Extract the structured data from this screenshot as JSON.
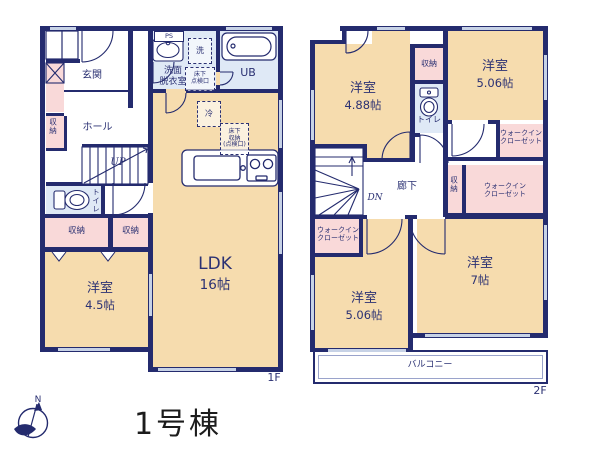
{
  "colors": {
    "wall": "#242b6e",
    "text": "#2b3173",
    "room": "#f6dcae",
    "closet": "#f9d9d9",
    "wet": "#dfe9f6",
    "window": "#c7d2e6",
    "balcony_line": "#9aa3cb",
    "title": "#1c1c1c"
  },
  "page": {
    "building_title": "1号棟",
    "compass_north": "N"
  },
  "floor1": {
    "floor_label": "1F",
    "labels": {
      "entrance": "玄関",
      "hall": "ホール",
      "up": "UP",
      "closet_side": "収納",
      "toilet": "トイレ",
      "closet_a": "収納",
      "closet_b": "収納",
      "room": "洋室",
      "room_size": "4.5帖",
      "ldk": "LDK",
      "ldk_size": "16帖",
      "washroom": "洗面\n脱衣室",
      "ps": "PS",
      "laundry": "洗",
      "bath": "UB",
      "fridge": "冷",
      "underfloor_hatch": "床下\n点検口",
      "underfloor_storage": "床下\n収納\n(点検口)"
    }
  },
  "floor2": {
    "floor_label": "2F",
    "labels": {
      "room_a": "洋室",
      "room_a_size": "4.88帖",
      "room_b": "洋室",
      "room_b_size": "5.06帖",
      "room_c": "洋室",
      "room_c_size": "5.06帖",
      "room_d": "洋室",
      "room_d_size": "7帖",
      "toilet": "トイレ",
      "closet_top": "収納",
      "closet_mid": "収納",
      "wic_a": "ウォークイン\nクローゼット",
      "wic_b": "ウォークイン\nクローゼット",
      "wic_c": "ウォークイン\nクローゼット",
      "corridor": "廊下",
      "dn": "DN",
      "balcony": "バルコニー"
    }
  }
}
